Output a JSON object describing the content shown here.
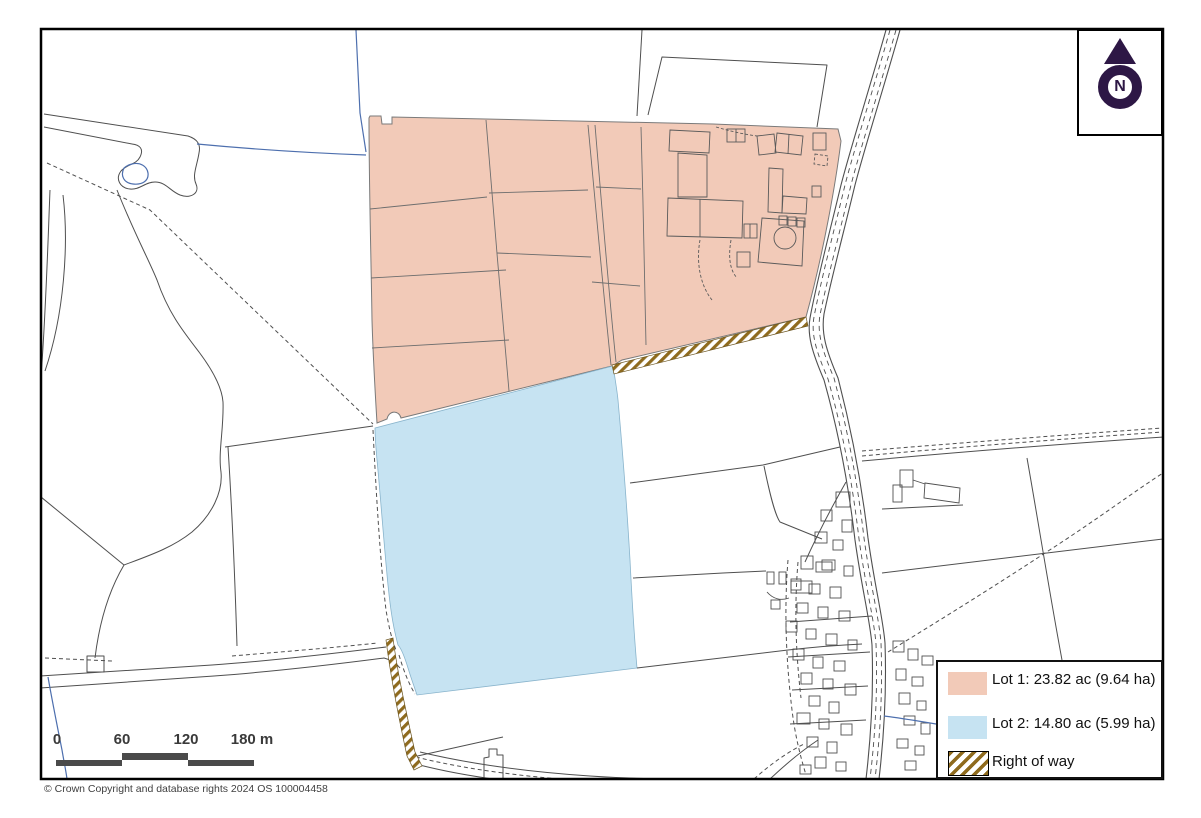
{
  "north_box": {
    "letter": "N"
  },
  "legend": {
    "items": [
      {
        "label": "Lot 1: 23.82 ac (9.64 ha)",
        "swatch_color": "#f2cab8",
        "type": "fill"
      },
      {
        "label": "Lot 2: 14.80 ac (5.99 ha)",
        "swatch_color": "#c6e3f2",
        "type": "fill"
      },
      {
        "label": "Right of way",
        "swatch_color": "#8f6b1e",
        "type": "hatch"
      }
    ]
  },
  "scale_bar": {
    "ticks": [
      "0",
      "60",
      "120",
      "180 m"
    ]
  },
  "footer": {
    "copyright": "© Crown Copyright and database rights 2024 OS 100004458"
  },
  "colors": {
    "lot1_fill": "#f2cab8",
    "lot2_fill": "#c6e3f2",
    "right_of_way_stripe": "#8f6b1e",
    "north_arrow": "#2d1745",
    "base_line": "#4f4f4f",
    "water_line": "#4d6fae",
    "scale_bar": "#4a4a4a"
  }
}
